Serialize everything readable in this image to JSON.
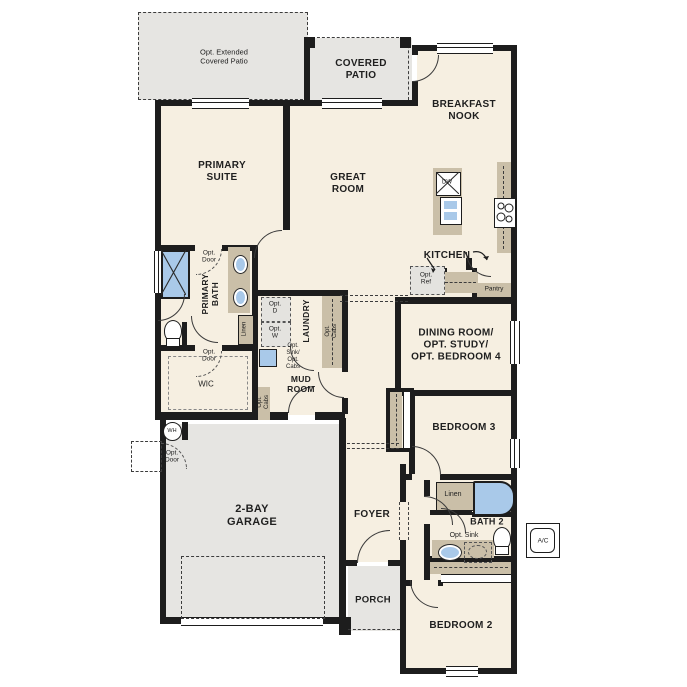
{
  "colors": {
    "wall": "#1d1d1d",
    "floor": "#f6efe1",
    "patio_garage": "#e6e5e2",
    "cabinet": "#cabfa8",
    "fixture_blue": "#a9c9e9",
    "optional_fill": "#e4e3df"
  },
  "rooms": {
    "opt_extended_patio": "Opt. Extended\nCovered Patio",
    "covered_patio": "COVERED\nPATIO",
    "breakfast_nook": "BREAKFAST\nNOOK",
    "primary_suite": "PRIMARY\nSUITE",
    "great_room": "GREAT\nROOM",
    "kitchen": "KITCHEN",
    "primary_bath": "PRIMARY\nBATH",
    "wic": "WIC",
    "laundry": "LAUNDRY",
    "mud_room": "MUD\nROOM",
    "dining": "DINING ROOM/\nOPT. STUDY/\nOPT. BEDROOM 4",
    "bedroom_3": "BEDROOM 3",
    "bath_2": "BATH 2",
    "bedroom_2": "BEDROOM 2",
    "garage": "2-BAY\nGARAGE",
    "foyer": "FOYER",
    "porch": "PORCH"
  },
  "ann": {
    "opt_door": "Opt.\nDoor",
    "linen": "Linen",
    "opt_d": "Opt.\nD",
    "opt_w": "Opt.\nW",
    "opt_sink_cabs": "Opt.\nSink/\nOpt.\nCabs",
    "opt_cabs": "Opt.\nCabs",
    "opt_ref": "Opt.\nRef",
    "opt_sink": "Opt. Sink",
    "pantry": "Pantry",
    "dw": "DW",
    "wh": "WH",
    "ac": "A/C"
  }
}
